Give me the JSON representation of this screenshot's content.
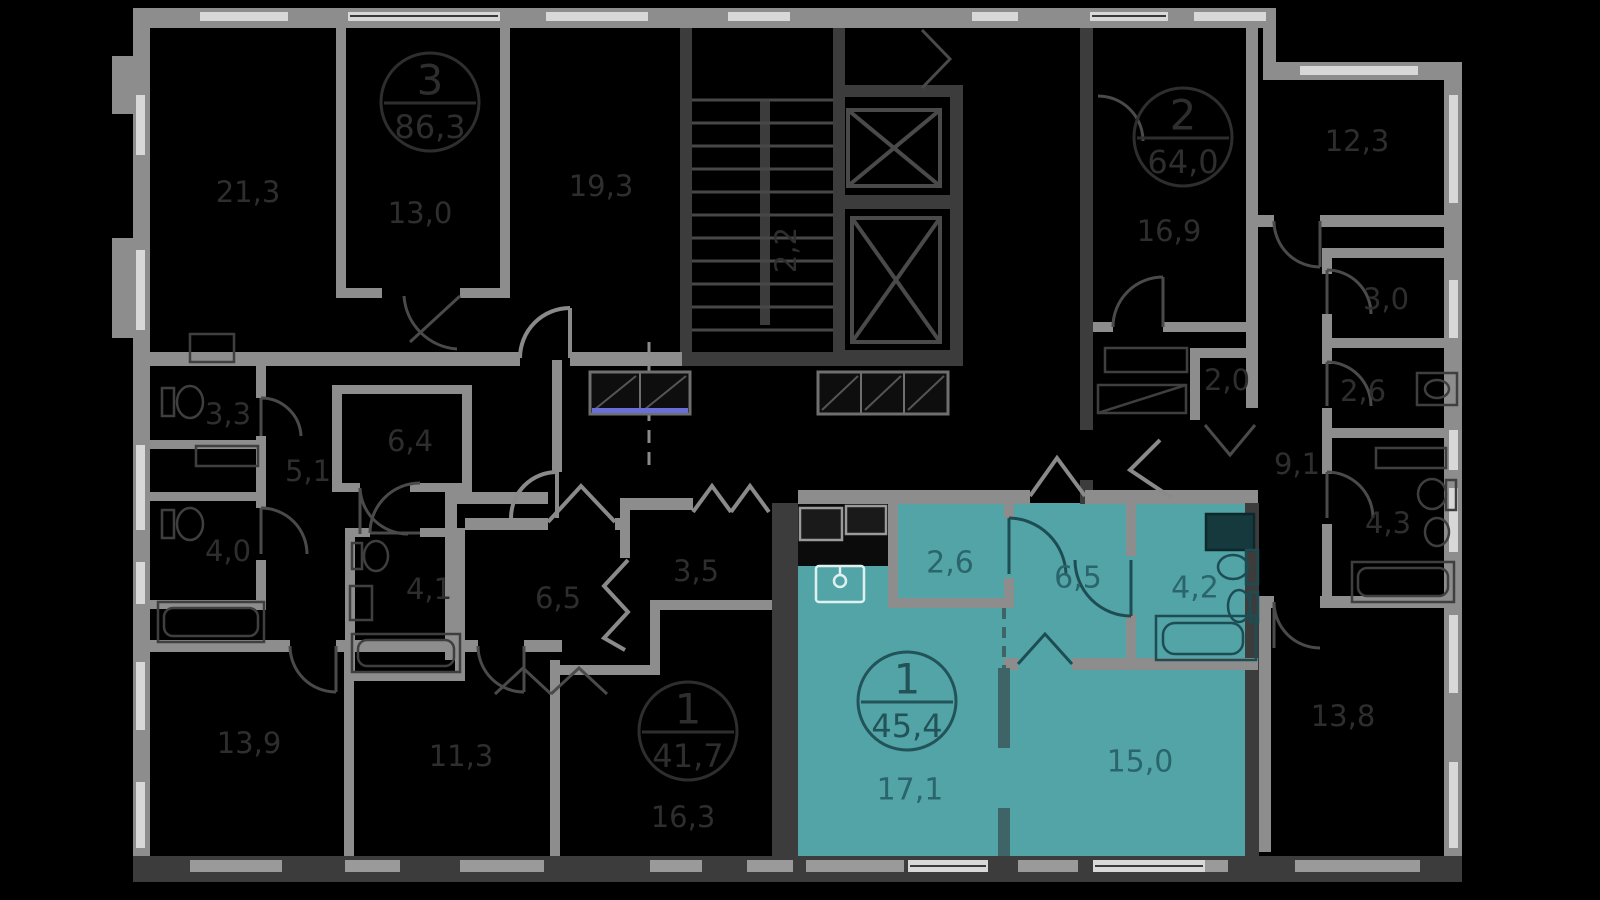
{
  "colors": {
    "background": "#000000",
    "selected_fill": "#52a4a7",
    "selected_outline": "#1d4d53",
    "selected_text": "#2b656c",
    "wall_gray": "#8d8d8d",
    "wall_dark": "#3c3c3c",
    "window_light": "#d8d8d8",
    "sill_gray": "#9a9a9a",
    "label_dim": "#2e2e2e",
    "glass_blue": "#6a6fd8"
  },
  "core": {
    "stairs_area_label": "2,2"
  },
  "apartments": [
    {
      "id": "apartment-3room-86",
      "selected": false,
      "badge": {
        "rooms": "3",
        "area": "86,3"
      },
      "room_areas": [
        "21,3",
        "13,0",
        "19,3",
        "3,3",
        "5,1",
        "6,4",
        "4,0",
        "13,9"
      ]
    },
    {
      "id": "apartment-2room-64",
      "selected": false,
      "badge": {
        "rooms": "2",
        "area": "64,0"
      },
      "room_areas": [
        "16,9",
        "12,3",
        "3,0",
        "2,0",
        "2,6",
        "9,1",
        "4,3",
        "13,8"
      ]
    },
    {
      "id": "apartment-1room-41",
      "selected": false,
      "badge": {
        "rooms": "1",
        "area": "41,7"
      },
      "room_areas": [
        "6,5",
        "3,5",
        "4,1",
        "11,3",
        "16,3"
      ]
    },
    {
      "id": "apartment-1room-45-selected",
      "selected": true,
      "badge": {
        "rooms": "1",
        "area": "45,4"
      },
      "room_areas": [
        "2,6",
        "6,5",
        "4,2",
        "17,1",
        "15,0"
      ]
    }
  ]
}
